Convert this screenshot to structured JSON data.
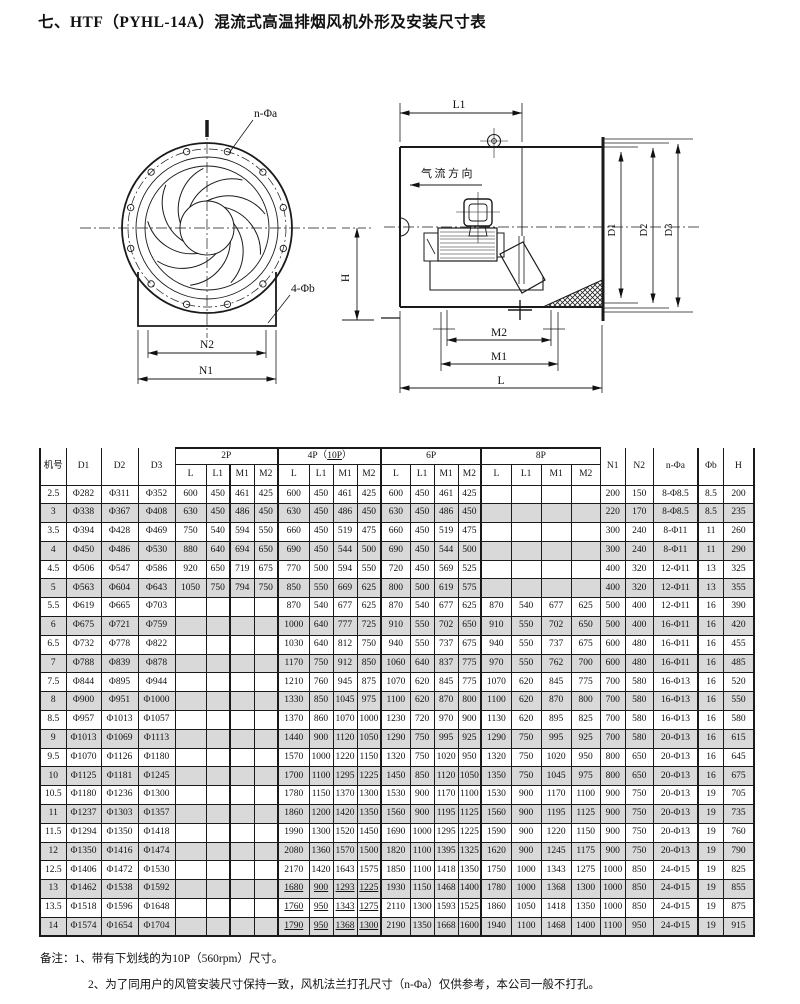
{
  "header": {
    "title": "七、HTF（PYHL-14A）混流式高温排烟风机外形及安装尺寸表"
  },
  "drawing": {
    "front_view": {
      "n_phi_a": "n-Φa",
      "four_phi_b": "4-Φb",
      "n2": "N2",
      "n1": "N1",
      "h": "H"
    },
    "side_view": {
      "l1": "L1",
      "airflow": "气流方向",
      "d1": "D1",
      "d2": "D2",
      "d3": "D3",
      "m2": "M2",
      "m1": "M1",
      "l": "L"
    }
  },
  "table": {
    "left_headers": [
      "机号",
      "D1",
      "D2",
      "D3"
    ],
    "groups": [
      {
        "label": "2P"
      },
      {
        "pre": "4P（",
        "u": "10P",
        "post": "）"
      },
      {
        "label": "6P"
      },
      {
        "label": "8P"
      }
    ],
    "sub_headers": [
      "L",
      "L1",
      "M1",
      "M2"
    ],
    "right_headers": [
      "N1",
      "N2",
      "n-Φa",
      "Φb",
      "H"
    ],
    "rows": [
      {
        "no": "2.5",
        "d1": "Φ282",
        "d2": "Φ311",
        "d3": "Φ352",
        "p2": [
          "600",
          "450",
          "461",
          "425"
        ],
        "p4": [
          "600",
          "450",
          "461",
          "425"
        ],
        "p6": [
          "600",
          "450",
          "461",
          "425"
        ],
        "p8": [
          "",
          "",
          "",
          ""
        ],
        "n1": "200",
        "n2": "150",
        "na": "8-Φ8.5",
        "fb": "8.5",
        "h": "200",
        "u": false
      },
      {
        "no": "3",
        "d1": "Φ338",
        "d2": "Φ367",
        "d3": "Φ408",
        "p2": [
          "630",
          "450",
          "486",
          "450"
        ],
        "p4": [
          "630",
          "450",
          "486",
          "450"
        ],
        "p6": [
          "630",
          "450",
          "486",
          "450"
        ],
        "p8": [
          "",
          "",
          "",
          ""
        ],
        "n1": "220",
        "n2": "170",
        "na": "8-Φ8.5",
        "fb": "8.5",
        "h": "235",
        "u": false
      },
      {
        "no": "3.5",
        "d1": "Φ394",
        "d2": "Φ428",
        "d3": "Φ469",
        "p2": [
          "750",
          "540",
          "594",
          "550"
        ],
        "p4": [
          "660",
          "450",
          "519",
          "475"
        ],
        "p6": [
          "660",
          "450",
          "519",
          "475"
        ],
        "p8": [
          "",
          "",
          "",
          ""
        ],
        "n1": "300",
        "n2": "240",
        "na": "8-Φ11",
        "fb": "11",
        "h": "260",
        "u": false
      },
      {
        "no": "4",
        "d1": "Φ450",
        "d2": "Φ486",
        "d3": "Φ530",
        "p2": [
          "880",
          "640",
          "694",
          "650"
        ],
        "p4": [
          "690",
          "450",
          "544",
          "500"
        ],
        "p6": [
          "690",
          "450",
          "544",
          "500"
        ],
        "p8": [
          "",
          "",
          "",
          ""
        ],
        "n1": "300",
        "n2": "240",
        "na": "8-Φ11",
        "fb": "11",
        "h": "290",
        "u": false
      },
      {
        "no": "4.5",
        "d1": "Φ506",
        "d2": "Φ547",
        "d3": "Φ586",
        "p2": [
          "920",
          "650",
          "719",
          "675"
        ],
        "p4": [
          "770",
          "500",
          "594",
          "550"
        ],
        "p6": [
          "720",
          "450",
          "569",
          "525"
        ],
        "p8": [
          "",
          "",
          "",
          ""
        ],
        "n1": "400",
        "n2": "320",
        "na": "12-Φ11",
        "fb": "13",
        "h": "325",
        "u": false
      },
      {
        "no": "5",
        "d1": "Φ563",
        "d2": "Φ604",
        "d3": "Φ643",
        "p2": [
          "1050",
          "750",
          "794",
          "750"
        ],
        "p4": [
          "850",
          "550",
          "669",
          "625"
        ],
        "p6": [
          "800",
          "500",
          "619",
          "575"
        ],
        "p8": [
          "",
          "",
          "",
          ""
        ],
        "n1": "400",
        "n2": "320",
        "na": "12-Φ11",
        "fb": "13",
        "h": "355",
        "u": false
      },
      {
        "no": "5.5",
        "d1": "Φ619",
        "d2": "Φ665",
        "d3": "Φ703",
        "p2": [
          "",
          "",
          "",
          ""
        ],
        "p4": [
          "870",
          "540",
          "677",
          "625"
        ],
        "p6": [
          "870",
          "540",
          "677",
          "625"
        ],
        "p8": [
          "870",
          "540",
          "677",
          "625"
        ],
        "n1": "500",
        "n2": "400",
        "na": "12-Φ11",
        "fb": "16",
        "h": "390",
        "u": false
      },
      {
        "no": "6",
        "d1": "Φ675",
        "d2": "Φ721",
        "d3": "Φ759",
        "p2": [
          "",
          "",
          "",
          ""
        ],
        "p4": [
          "1000",
          "640",
          "777",
          "725"
        ],
        "p6": [
          "910",
          "550",
          "702",
          "650"
        ],
        "p8": [
          "910",
          "550",
          "702",
          "650"
        ],
        "n1": "500",
        "n2": "400",
        "na": "16-Φ11",
        "fb": "16",
        "h": "420",
        "u": false
      },
      {
        "no": "6.5",
        "d1": "Φ732",
        "d2": "Φ778",
        "d3": "Φ822",
        "p2": [
          "",
          "",
          "",
          ""
        ],
        "p4": [
          "1030",
          "640",
          "812",
          "750"
        ],
        "p6": [
          "940",
          "550",
          "737",
          "675"
        ],
        "p8": [
          "940",
          "550",
          "737",
          "675"
        ],
        "n1": "600",
        "n2": "480",
        "na": "16-Φ11",
        "fb": "16",
        "h": "455",
        "u": false
      },
      {
        "no": "7",
        "d1": "Φ788",
        "d2": "Φ839",
        "d3": "Φ878",
        "p2": [
          "",
          "",
          "",
          ""
        ],
        "p4": [
          "1170",
          "750",
          "912",
          "850"
        ],
        "p6": [
          "1060",
          "640",
          "837",
          "775"
        ],
        "p8": [
          "970",
          "550",
          "762",
          "700"
        ],
        "n1": "600",
        "n2": "480",
        "na": "16-Φ11",
        "fb": "16",
        "h": "485",
        "u": false
      },
      {
        "no": "7.5",
        "d1": "Φ844",
        "d2": "Φ895",
        "d3": "Φ944",
        "p2": [
          "",
          "",
          "",
          ""
        ],
        "p4": [
          "1210",
          "760",
          "945",
          "875"
        ],
        "p6": [
          "1070",
          "620",
          "845",
          "775"
        ],
        "p8": [
          "1070",
          "620",
          "845",
          "775"
        ],
        "n1": "700",
        "n2": "580",
        "na": "16-Φ13",
        "fb": "16",
        "h": "520",
        "u": false
      },
      {
        "no": "8",
        "d1": "Φ900",
        "d2": "Φ951",
        "d3": "Φ1000",
        "p2": [
          "",
          "",
          "",
          ""
        ],
        "p4": [
          "1330",
          "850",
          "1045",
          "975"
        ],
        "p6": [
          "1100",
          "620",
          "870",
          "800"
        ],
        "p8": [
          "1100",
          "620",
          "870",
          "800"
        ],
        "n1": "700",
        "n2": "580",
        "na": "16-Φ13",
        "fb": "16",
        "h": "550",
        "u": false
      },
      {
        "no": "8.5",
        "d1": "Φ957",
        "d2": "Φ1013",
        "d3": "Φ1057",
        "p2": [
          "",
          "",
          "",
          ""
        ],
        "p4": [
          "1370",
          "860",
          "1070",
          "1000"
        ],
        "p6": [
          "1230",
          "720",
          "970",
          "900"
        ],
        "p8": [
          "1130",
          "620",
          "895",
          "825"
        ],
        "n1": "700",
        "n2": "580",
        "na": "16-Φ13",
        "fb": "16",
        "h": "580",
        "u": false
      },
      {
        "no": "9",
        "d1": "Φ1013",
        "d2": "Φ1069",
        "d3": "Φ1113",
        "p2": [
          "",
          "",
          "",
          ""
        ],
        "p4": [
          "1440",
          "900",
          "1120",
          "1050"
        ],
        "p6": [
          "1290",
          "750",
          "995",
          "925"
        ],
        "p8": [
          "1290",
          "750",
          "995",
          "925"
        ],
        "n1": "700",
        "n2": "580",
        "na": "20-Φ13",
        "fb": "16",
        "h": "615",
        "u": false
      },
      {
        "no": "9.5",
        "d1": "Φ1070",
        "d2": "Φ1126",
        "d3": "Φ1180",
        "p2": [
          "",
          "",
          "",
          ""
        ],
        "p4": [
          "1570",
          "1000",
          "1220",
          "1150"
        ],
        "p6": [
          "1320",
          "750",
          "1020",
          "950"
        ],
        "p8": [
          "1320",
          "750",
          "1020",
          "950"
        ],
        "n1": "800",
        "n2": "650",
        "na": "20-Φ13",
        "fb": "16",
        "h": "645",
        "u": false
      },
      {
        "no": "10",
        "d1": "Φ1125",
        "d2": "Φ1181",
        "d3": "Φ1245",
        "p2": [
          "",
          "",
          "",
          ""
        ],
        "p4": [
          "1700",
          "1100",
          "1295",
          "1225"
        ],
        "p6": [
          "1450",
          "850",
          "1120",
          "1050"
        ],
        "p8": [
          "1350",
          "750",
          "1045",
          "975"
        ],
        "n1": "800",
        "n2": "650",
        "na": "20-Φ13",
        "fb": "16",
        "h": "675",
        "u": false
      },
      {
        "no": "10.5",
        "d1": "Φ1180",
        "d2": "Φ1236",
        "d3": "Φ1300",
        "p2": [
          "",
          "",
          "",
          ""
        ],
        "p4": [
          "1780",
          "1150",
          "1370",
          "1300"
        ],
        "p6": [
          "1530",
          "900",
          "1170",
          "1100"
        ],
        "p8": [
          "1530",
          "900",
          "1170",
          "1100"
        ],
        "n1": "900",
        "n2": "750",
        "na": "20-Φ13",
        "fb": "19",
        "h": "705",
        "u": false
      },
      {
        "no": "11",
        "d1": "Φ1237",
        "d2": "Φ1303",
        "d3": "Φ1357",
        "p2": [
          "",
          "",
          "",
          ""
        ],
        "p4": [
          "1860",
          "1200",
          "1420",
          "1350"
        ],
        "p6": [
          "1560",
          "900",
          "1195",
          "1125"
        ],
        "p8": [
          "1560",
          "900",
          "1195",
          "1125"
        ],
        "n1": "900",
        "n2": "750",
        "na": "20-Φ13",
        "fb": "19",
        "h": "735",
        "u": false
      },
      {
        "no": "11.5",
        "d1": "Φ1294",
        "d2": "Φ1350",
        "d3": "Φ1418",
        "p2": [
          "",
          "",
          "",
          ""
        ],
        "p4": [
          "1990",
          "1300",
          "1520",
          "1450"
        ],
        "p6": [
          "1690",
          "1000",
          "1295",
          "1225"
        ],
        "p8": [
          "1590",
          "900",
          "1220",
          "1150"
        ],
        "n1": "900",
        "n2": "750",
        "na": "20-Φ13",
        "fb": "19",
        "h": "760",
        "u": false
      },
      {
        "no": "12",
        "d1": "Φ1350",
        "d2": "Φ1416",
        "d3": "Φ1474",
        "p2": [
          "",
          "",
          "",
          ""
        ],
        "p4": [
          "2080",
          "1360",
          "1570",
          "1500"
        ],
        "p6": [
          "1820",
          "1100",
          "1395",
          "1325"
        ],
        "p8": [
          "1620",
          "900",
          "1245",
          "1175"
        ],
        "n1": "900",
        "n2": "750",
        "na": "20-Φ13",
        "fb": "19",
        "h": "790",
        "u": false
      },
      {
        "no": "12.5",
        "d1": "Φ1406",
        "d2": "Φ1472",
        "d3": "Φ1530",
        "p2": [
          "",
          "",
          "",
          ""
        ],
        "p4": [
          "2170",
          "1420",
          "1643",
          "1575"
        ],
        "p6": [
          "1850",
          "1100",
          "1418",
          "1350"
        ],
        "p8": [
          "1750",
          "1000",
          "1343",
          "1275"
        ],
        "n1": "1000",
        "n2": "850",
        "na": "24-Φ15",
        "fb": "19",
        "h": "825",
        "u": false
      },
      {
        "no": "13",
        "d1": "Φ1462",
        "d2": "Φ1538",
        "d3": "Φ1592",
        "p2": [
          "",
          "",
          "",
          ""
        ],
        "p4": [
          "1680",
          "900",
          "1293",
          "1225"
        ],
        "p6": [
          "1930",
          "1150",
          "1468",
          "1400"
        ],
        "p8": [
          "1780",
          "1000",
          "1368",
          "1300"
        ],
        "n1": "1000",
        "n2": "850",
        "na": "24-Φ15",
        "fb": "19",
        "h": "855",
        "u": true
      },
      {
        "no": "13.5",
        "d1": "Φ1518",
        "d2": "Φ1596",
        "d3": "Φ1648",
        "p2": [
          "",
          "",
          "",
          ""
        ],
        "p4": [
          "1760",
          "950",
          "1343",
          "1275"
        ],
        "p6": [
          "2110",
          "1300",
          "1593",
          "1525"
        ],
        "p8": [
          "1860",
          "1050",
          "1418",
          "1350"
        ],
        "n1": "1000",
        "n2": "850",
        "na": "24-Φ15",
        "fb": "19",
        "h": "875",
        "u": true
      },
      {
        "no": "14",
        "d1": "Φ1574",
        "d2": "Φ1654",
        "d3": "Φ1704",
        "p2": [
          "",
          "",
          "",
          ""
        ],
        "p4": [
          "1790",
          "950",
          "1368",
          "1300"
        ],
        "p6": [
          "2190",
          "1350",
          "1668",
          "1600"
        ],
        "p8": [
          "1940",
          "1100",
          "1468",
          "1400"
        ],
        "n1": "1100",
        "n2": "950",
        "na": "24-Φ15",
        "fb": "19",
        "h": "915",
        "u": true
      }
    ]
  },
  "notes": {
    "label": "备注：",
    "items": [
      "1、带有下划线的为10P（560rpm）尺寸。",
      "2、为了同用户的风管安装尺寸保持一致，风机法兰打孔尺寸（n-Φa）仅供参考，本公司一般不打孔。"
    ]
  }
}
